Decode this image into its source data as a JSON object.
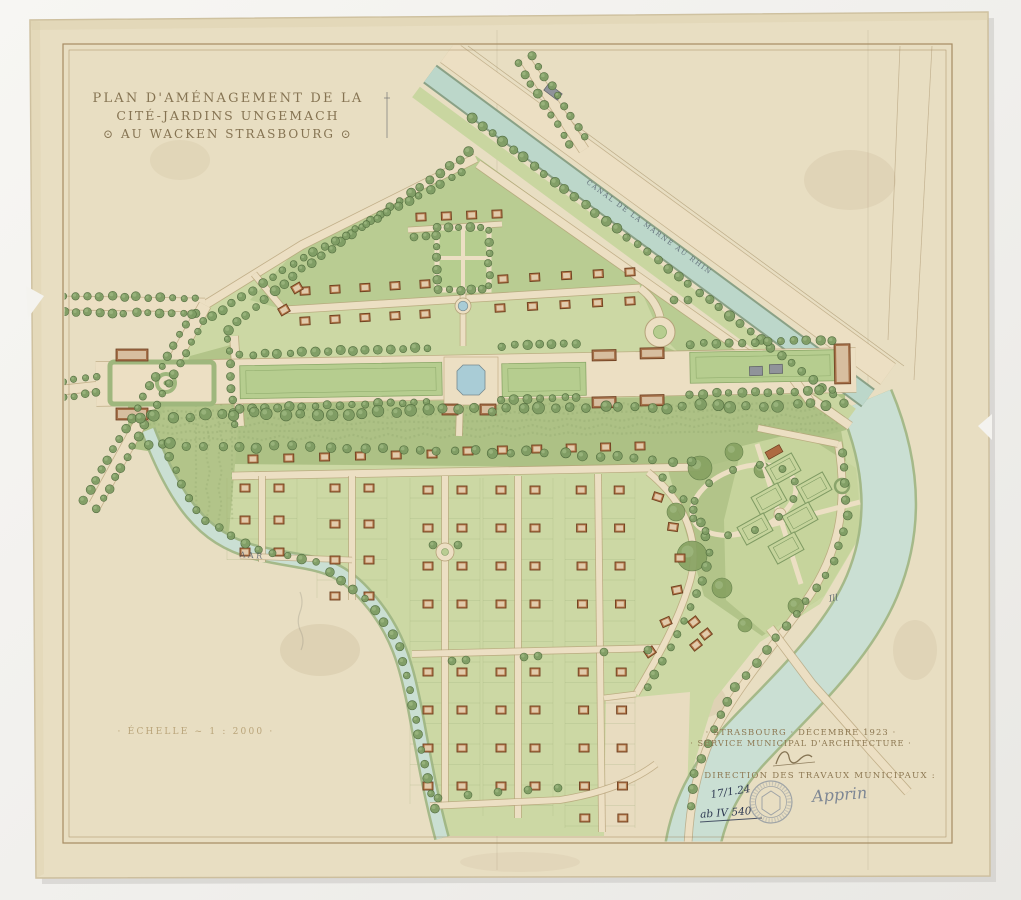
{
  "title": {
    "line1": "PLAN D'AMÉNAGEMENT DE LA",
    "line2": "CITÉ-JARDINS UNGEMACH",
    "line3": "⊙ AU WACKEN STRASBOURG ⊙"
  },
  "scale": {
    "text": "· ÉCHELLE ~ 1 : 2000 ·"
  },
  "labels": {
    "canal": "CANAL DE LA MARNE AU RHIN",
    "river_west": "AAR",
    "river_east": "Ill"
  },
  "credits": {
    "line1": "· STRASBOURG · DÉCEMBRE 1923 ·",
    "line2": "· SERVICE MUNICIPAL D'ARCHITECTURE ·",
    "line3": "DIRECTION DES TRAVAUX MUNICIPAUX :"
  },
  "annotations": {
    "date_note": "17/1.24",
    "file_ref": "ab IV 540",
    "approval_signature": "Apprin"
  },
  "palette": {
    "scan_bg": "#f4f3ef",
    "shadow": "#c9c7c2",
    "paper": "#e8dec2",
    "paper_edge": "#cdbf9e",
    "frame": "#9b7e52",
    "parcel": "#ccd8a4",
    "lawn": "#b9cc92",
    "lawn_dark": "#b2c489",
    "belt": "#adc185",
    "road": "#ecdfc3",
    "road_edge": "#b5a077",
    "water": "#cadfd3",
    "water_edge": "#9db583",
    "basin": "#a9ccd6",
    "tree": "#7e9c63",
    "tree_dark": "#4f6a3c",
    "tree_light": "#a3bd85",
    "hedge": "#c6d49c",
    "hedge_edge": "#7e9a62",
    "house_fill": "#b5794a",
    "house_edge": "#6e3f20",
    "house_roof": "#e9d9bd",
    "grey_building": "#90939a",
    "ink": "#7d6b49",
    "ink_faint": "#b7a176",
    "ink_blue": "#55606e",
    "pencil": "#7e8794",
    "hand_ink": "#2f3a52",
    "stamp": "#8e96a0"
  }
}
